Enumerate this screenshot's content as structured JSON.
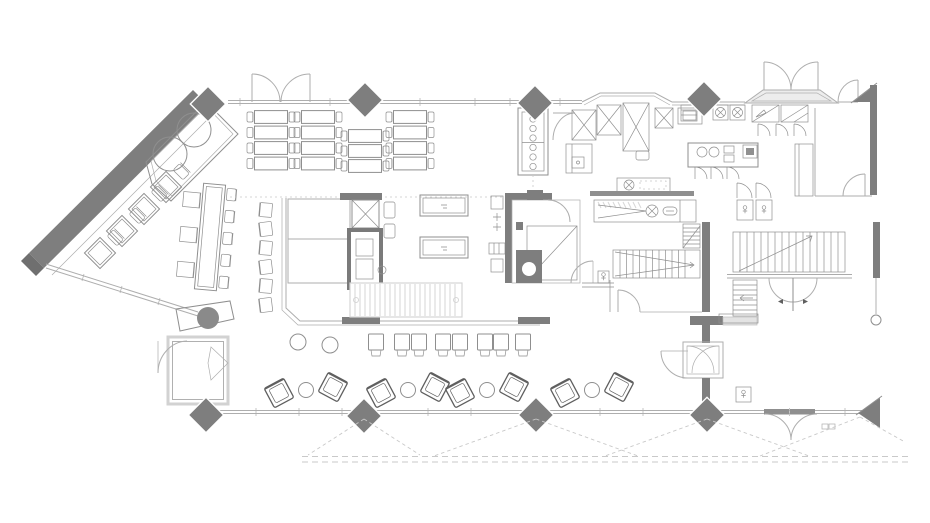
{
  "meta": {
    "label": "Restaurant and bar floor plan drawing",
    "canvas": {
      "width": 930,
      "height": 523
    }
  },
  "colors": {
    "wall": "#7e7e7e",
    "wall_dark": "#6f6f6f",
    "line": "#aeaeae",
    "line_md": "#8f8f8f",
    "line_dark": "#5f5f5f",
    "hatch": "#d6d6d6",
    "dashed": "#c9c9c9",
    "light_fill": "#ededed",
    "background": "#ffffff"
  },
  "inventory": {
    "dining_tables_two_seat": 15,
    "diagonal_wall_tables": 4,
    "communal_table_seats_left": 3,
    "communal_table_chairs_right": 5,
    "bench_chairs": 6,
    "bar_stools_square": 8,
    "small_round_tables": 2,
    "lounge_groups": 4,
    "booth_round_tables": 2,
    "structural_diamond_columns": 8,
    "corner_columns": 2,
    "staircases": 3
  },
  "furniture": {
    "columns": [
      [
        208,
        104
      ],
      [
        365,
        100
      ],
      [
        535,
        103
      ],
      [
        704,
        99
      ],
      [
        206,
        415
      ],
      [
        364,
        416
      ],
      [
        536,
        415
      ],
      [
        707,
        415
      ]
    ],
    "top_tables": [
      {
        "x": 271,
        "ys": [
          117,
          132.5,
          148,
          163.5
        ]
      },
      {
        "x": 318,
        "ys": [
          117,
          132.5,
          148,
          163.5
        ]
      },
      {
        "x": 365,
        "ys": [
          136,
          151,
          166
        ]
      },
      {
        "x": 410,
        "ys": [
          117,
          132.5,
          148,
          163.5
        ]
      }
    ],
    "diag_tables": [
      [
        100,
        253
      ],
      [
        122,
        231
      ],
      [
        144,
        209
      ],
      [
        166,
        187
      ]
    ],
    "bench_chair_ys": [
      210,
      229,
      248,
      267,
      286,
      305
    ],
    "bar_stool_xs": [
      376,
      402,
      419,
      443,
      460,
      485,
      501,
      523
    ],
    "round_tables": [
      [
        298,
        342
      ],
      [
        330,
        345
      ]
    ],
    "lounge_xs": [
      306,
      408,
      487,
      592
    ],
    "booth_circles": [
      [
        194,
        130
      ],
      [
        170,
        154
      ]
    ]
  }
}
